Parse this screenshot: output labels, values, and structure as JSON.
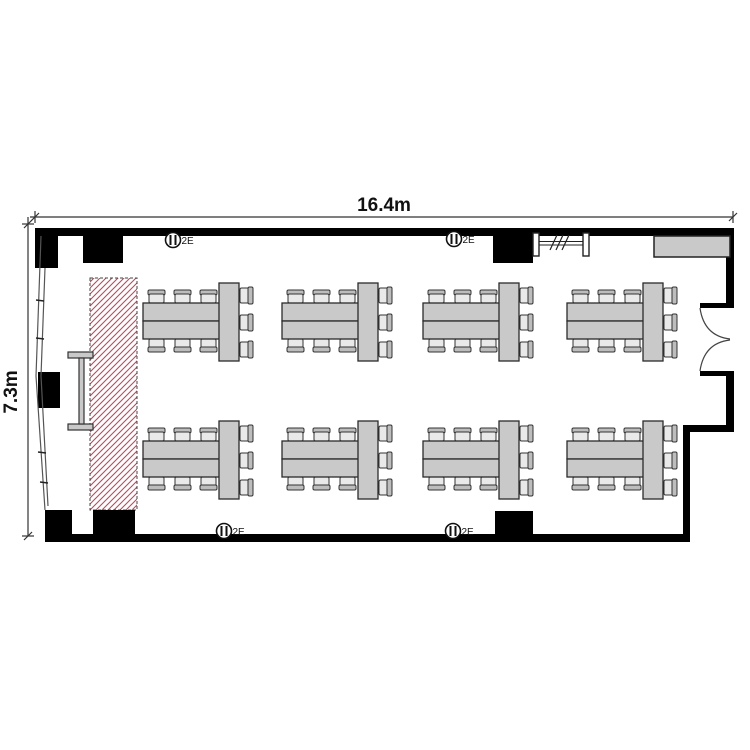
{
  "floor_plan": {
    "type": "room-layout-floor-plan",
    "dimension_width_label": "16.4m",
    "dimension_height_label": "7.3m",
    "outlet_label": "2E",
    "colors": {
      "wall": "#000000",
      "line": "#333333",
      "furniture_fill": "#c9c9c9",
      "furniture_stroke": "#2b2b2b",
      "chair_seat_fill": "#e9e9e9",
      "chair_back_fill": "#bdbdbd",
      "hatch_red": "#b94a5a",
      "hatch_border": "#444444",
      "counter_fill": "#c9c9c9"
    },
    "walls": [
      {
        "name": "wall-top",
        "x": 35,
        "y": 228,
        "w": 699,
        "h": 8
      },
      {
        "name": "wall-right-upper",
        "x": 726,
        "y": 228,
        "w": 8,
        "h": 77
      },
      {
        "name": "door-jamb-top",
        "x": 700,
        "y": 303,
        "w": 34,
        "h": 5
      },
      {
        "name": "door-jamb-bottom",
        "x": 700,
        "y": 371,
        "w": 34,
        "h": 5
      },
      {
        "name": "wall-right-mid",
        "x": 726,
        "y": 376,
        "w": 8,
        "h": 53
      },
      {
        "name": "wall-step",
        "x": 688,
        "y": 425,
        "w": 46,
        "h": 7
      },
      {
        "name": "wall-right-lower",
        "x": 683,
        "y": 425,
        "w": 7,
        "h": 117
      },
      {
        "name": "wall-bottom",
        "x": 45,
        "y": 534,
        "w": 644,
        "h": 8
      }
    ],
    "pillars": [
      {
        "x": 35,
        "y": 228,
        "w": 23,
        "h": 40
      },
      {
        "x": 83,
        "y": 228,
        "w": 40,
        "h": 35
      },
      {
        "x": 493,
        "y": 228,
        "w": 40,
        "h": 35
      },
      {
        "x": 38,
        "y": 372,
        "w": 22,
        "h": 36
      },
      {
        "x": 45,
        "y": 510,
        "w": 27,
        "h": 31
      },
      {
        "x": 93,
        "y": 510,
        "w": 42,
        "h": 31
      },
      {
        "x": 495,
        "y": 511,
        "w": 38,
        "h": 30
      }
    ],
    "outlets": [
      {
        "cx": 173,
        "cy": 240
      },
      {
        "cx": 454,
        "cy": 239
      },
      {
        "cx": 224,
        "cy": 531
      },
      {
        "cx": 453,
        "cy": 531
      }
    ],
    "screen_area": {
      "x": 90,
      "y": 278,
      "w": 47,
      "h": 232
    },
    "whiteboard_stand": {
      "bar": {
        "x": 79,
        "y": 358,
        "w": 5,
        "h": 66
      },
      "caps": [
        {
          "x": 68,
          "y": 352,
          "w": 25,
          "h": 6
        },
        {
          "x": 68,
          "y": 424,
          "w": 25,
          "h": 6
        }
      ]
    },
    "coat_rack": {
      "posts": [
        {
          "x": 533,
          "y": 233,
          "w": 6,
          "h": 23
        },
        {
          "x": 583,
          "y": 233,
          "w": 6,
          "h": 23
        }
      ],
      "rail_x1": 539,
      "rail_x2": 583,
      "rail_y1": 241.5,
      "rail_y2": 245,
      "slash_xs": [
        550,
        556,
        562
      ],
      "slash_y1": 250,
      "slash_y2": 235,
      "slash_dx": 7
    },
    "counter": {
      "x": 654,
      "y": 236,
      "w": 76,
      "h": 21
    },
    "door": {
      "jamb_x": 700,
      "top_y": 308,
      "bottom_y": 371,
      "meet_x": 730,
      "meet_y": 339
    },
    "window_wall": {
      "outer": "M41,236 L36,376 L45,510",
      "inner": "M45,268 L41,376 L48,506",
      "ticks": [
        [
          36,
          300,
          44,
          301
        ],
        [
          36,
          338,
          44,
          339
        ],
        [
          38,
          452,
          46,
          453
        ],
        [
          40,
          482,
          48,
          483
        ]
      ]
    },
    "table_groups": [
      {
        "x": 143,
        "y": 283
      },
      {
        "x": 282,
        "y": 283
      },
      {
        "x": 423,
        "y": 283
      },
      {
        "x": 567,
        "y": 283
      },
      {
        "x": 143,
        "y": 421
      },
      {
        "x": 282,
        "y": 421
      },
      {
        "x": 423,
        "y": 421
      },
      {
        "x": 567,
        "y": 421
      }
    ],
    "table_group_layout": {
      "long_table": {
        "dx": 0,
        "dy": 20,
        "w": 78,
        "row_h": 18,
        "rows": 2
      },
      "end_table": {
        "dx": 76,
        "dy": 0,
        "w": 20,
        "h": 78
      },
      "chairs_top_dx": [
        5,
        31,
        57
      ],
      "chairs_bottom_dx": [
        5,
        31,
        57
      ],
      "chairs_right_dy": [
        4,
        31,
        58
      ]
    },
    "dim_top": {
      "x1": 30,
      "x2": 733,
      "y": 217,
      "tick1": 35,
      "tick2": 733,
      "label_x": 384,
      "label_y": 211
    },
    "dim_left": {
      "x": 28,
      "y1": 217,
      "y2": 536,
      "tick1": 224,
      "tick2": 536,
      "label_x": 17,
      "label_y": 392
    }
  }
}
